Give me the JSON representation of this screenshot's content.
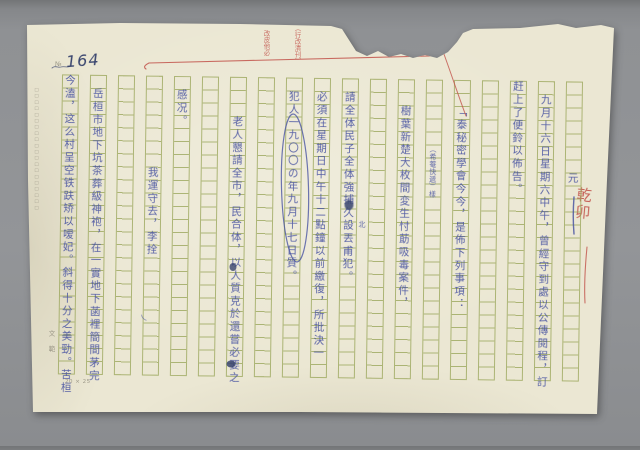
{
  "document_type": "handwritten manuscript page on green-grid stationery (scanned, torn top edge)",
  "colors": {
    "background": "#8f9194",
    "paper": "#ebe7d3",
    "grid": "#9aa65a",
    "ink": "#4a55a2",
    "ink_dark": "#39456e",
    "red": "#c2524a",
    "print_gray": "#8a8677"
  },
  "page": {
    "number": "164",
    "number_prefix": "№"
  },
  "grid": {
    "columns": 19,
    "rows": 23,
    "size_label": "20 × 25"
  },
  "margin_prints": {
    "left_vertical_print": "□□□□□□□□□□□□□□□□□□□□",
    "brand": "文範",
    "grid_size": "20 × 25"
  },
  "red_annotations": {
    "top_note_left": "改皮他必",
    "top_note_right": "（行改清刊）",
    "signature": "乾卯"
  },
  "manuscript": {
    "reading_order": "vertical columns, right to left",
    "columns": [
      {
        "grid_col": 19,
        "start_row": 8,
        "text": "元"
      },
      {
        "grid_col": 18,
        "start_row": 2,
        "text": "九月十六日星期六中午，曾經守到處以公傳閱程，訂"
      },
      {
        "grid_col": 17,
        "start_row": 1,
        "text": "赶上了便鈴以佈告。"
      },
      {
        "grid_col": 15,
        "start_row": 3,
        "text": "「泰秘密學會今今，是佈下列事項："
      },
      {
        "grid_col": 13,
        "start_row": 3,
        "text": "樹葉新楚大枚間変生忖莇吸毒案件，"
      },
      {
        "grid_col": 11,
        "start_row": 2,
        "text": "請全体民子全体強捕久設丟甫犯。"
      },
      {
        "grid_col": 10,
        "start_row": 2,
        "text": "必須在星期日中午十二點鐘以前繳復，所批決一"
      },
      {
        "grid_col": 9,
        "start_row": 2,
        "text": "犯人一九〇〇の年九月十七日質。"
      },
      {
        "grid_col": 7,
        "start_row": 4,
        "text": "老人懇請全市，民合体，以人質克於還嘗必要之"
      },
      {
        "grid_col": 5,
        "start_row": 2,
        "text": "感况。"
      },
      {
        "grid_col": 4,
        "start_row": 8,
        "text": "我運守去，李拴"
      },
      {
        "grid_col": 2,
        "start_row": 2,
        "text": "岳桓市地下坑茶葬級神袍，在一實地下菡裡簡間茅完"
      },
      {
        "grid_col": 1,
        "start_row": 1,
        "text": "今溘，这么村呈空铁趺矫以嗳妃。斜得十分之美勁。苦桓"
      }
    ],
    "inline_inserts": [
      {
        "text": "（希菴快遞）樣",
        "x": 429,
        "y": 144
      },
      {
        "text": "北",
        "x": 359,
        "y": 220
      },
      {
        "text": "乀",
        "x": 142,
        "y": 316
      }
    ],
    "circled_annotation": {
      "text": "一九〇〇の年九月十七日",
      "grid_col": 9,
      "rows": "4–14"
    }
  }
}
